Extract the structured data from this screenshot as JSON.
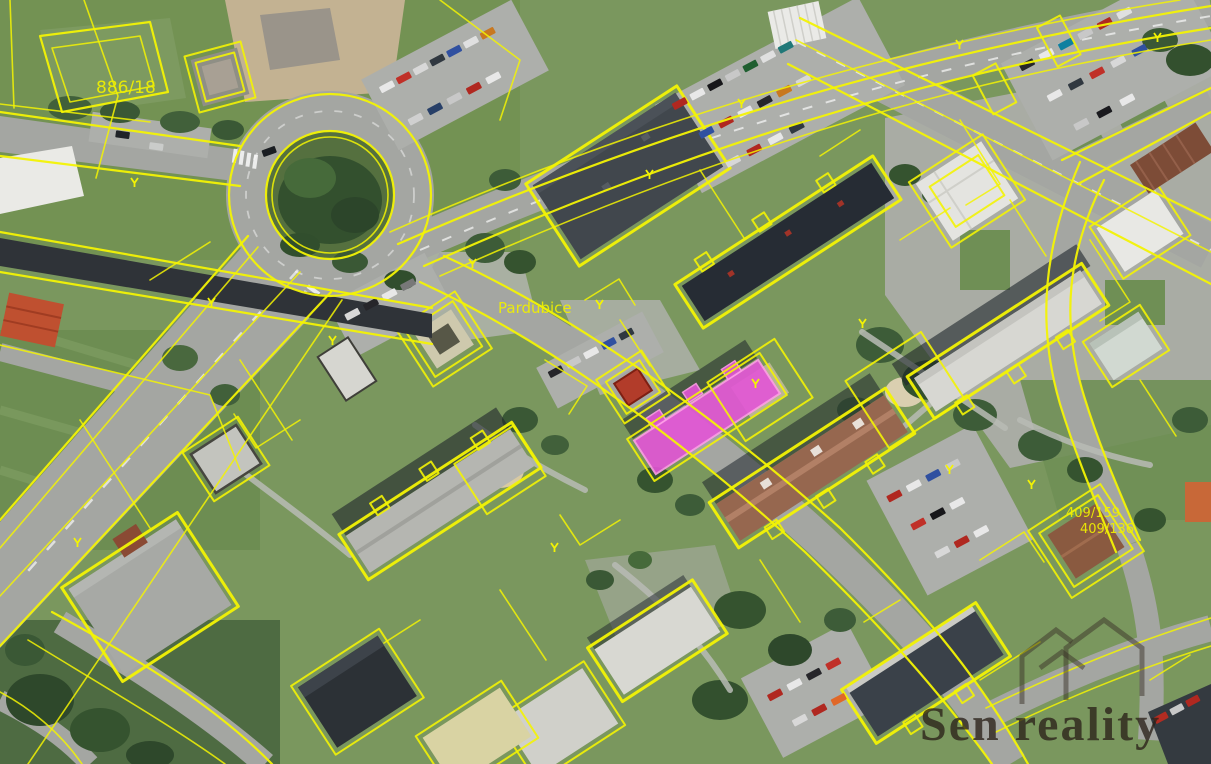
{
  "map": {
    "city_label": "Pardubice",
    "parcel_labels": {
      "tl": "886/18",
      "br1": "409/159",
      "br2": "409/136"
    },
    "highlighted_building_color": "#e455d7",
    "highlighted_building_border": "#ff9ce8",
    "cadastral_line_color": "#f3f304"
  },
  "watermark": {
    "brand": "Sen reality",
    "icon": "house-outline-icon",
    "color": "#2b221a"
  }
}
